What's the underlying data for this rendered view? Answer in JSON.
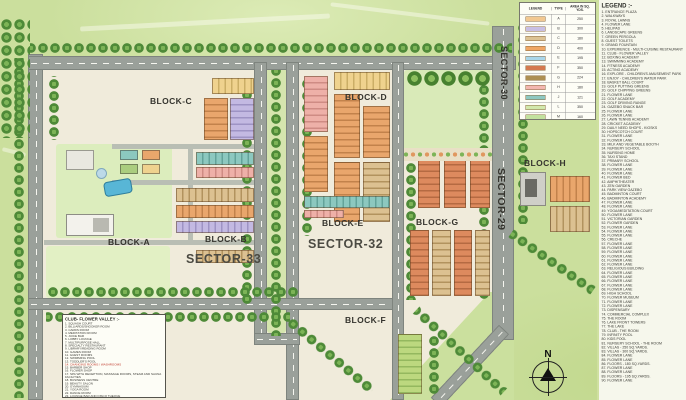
{
  "map": {
    "labels": {
      "block_a": "BLOCK-A",
      "block_b": "BLOCK-B",
      "block_c": "BLOCK-C",
      "block_d": "BLOCK-D",
      "block_e": "BLOCK-E",
      "block_f": "BLOCK-F",
      "block_g": "BLOCK-G",
      "block_h": "BLOCK-H",
      "sector_29": "SECTOR-29",
      "sector_30": "SECTOR-30",
      "sector_32": "SECTOR-32",
      "sector_33": "SECTOR-33"
    },
    "compass": {
      "north_label": "N"
    }
  },
  "legend_table": {
    "headers": [
      "LEGEND",
      "TYPE",
      "AREA IN SQ. YDS."
    ],
    "rows": [
      {
        "color": "#f2c891",
        "type": "A",
        "area": "250"
      },
      {
        "color": "#c9bfe4",
        "type": "B",
        "area": "300"
      },
      {
        "color": "#dcc394",
        "type": "C",
        "area": "180"
      },
      {
        "color": "#f0a765",
        "type": "D",
        "area": "400"
      },
      {
        "color": "#a9d6ea",
        "type": "E",
        "area": "195"
      },
      {
        "color": "#d4794f",
        "type": "F",
        "area": "350"
      },
      {
        "color": "#ad8f52",
        "type": "G",
        "area": "224"
      },
      {
        "color": "#f3b7b0",
        "type": "H",
        "area": "180"
      },
      {
        "color": "#8ec8c1",
        "type": "J",
        "area": "121"
      },
      {
        "color": "#d2e8ac",
        "type": "L",
        "area": "350"
      },
      {
        "color": "#c2e19e",
        "type": "M",
        "area": "160"
      }
    ]
  },
  "legend": {
    "title": "LEGEND :-",
    "items": [
      "ENTRANCE PLAZA",
      "WALKWAYS",
      "ROYAL LAWNS",
      "FLOWER LANE",
      "HELIPAD",
      "LANDSCAPE GREENS",
      "GREEN PERGOLA",
      "GUEST TOILETS",
      "GRAND FOUNTAIN",
      "EXPERIENCE - MULTI-CUISINE RESTAURANT",
      "CLUB - FLOWER VALLEY",
      "BOXING ACADEMY",
      "SWIMMING ACADEMY",
      "FITNESS ACADEMY",
      "ACTING ACADEMY",
      "EXPLORE - CHILDREN'S AMUSEMENT PARK",
      "ENJOY - CHILDREN'S WATER PARK",
      "BASKET BALL COURT",
      "GOLF PUTTING GREENS",
      "GOLF CHIPPING GREENS",
      "FLOWER LANE",
      "GOLF ACADEMY",
      "GOLF DRIVING RANGE",
      "GAZEBO SNACK BAR",
      "FLOWER LANE",
      "FLOWER LANE",
      "LAWN TENNIS ACADEMY",
      "CRICKET ACADEMY",
      "DAILY NEED SHOPS - KIOSKS",
      "HOPSCOTCH COURT",
      "FLOWER LANE",
      "FLOWER LANE",
      "MILK AND VEGETABLE BOOTH",
      "NURSERY SCHOOL",
      "NURSING HOME",
      "TAXI STAND",
      "PRIMARY SCHOOL",
      "FLOWER LANE",
      "FLOWER LANE",
      "FLOWER LANE",
      "FLOWER BED",
      "AMPHITHEATER",
      "ZEN GARDEN",
      "PARK VIEW GAZEBO",
      "BADMINTON COURT",
      "BADMINTON ACADEMY",
      "FLOWER LANE",
      "FLOWER LANE",
      "YOGA/MEDITATION COURT",
      "FLOWER LANE",
      "VICTORIAN GARDEN",
      "FLOWER GARDEN",
      "FLOWER LANE",
      "FLOWER LANE",
      "FLOWER LANE",
      "CRECHE",
      "FLOWER LANE",
      "FLOWER LANE",
      "FLOWER LANE",
      "FLOWER LANE",
      "FLOWER LANE",
      "FLOWER LANE",
      "RELIGIOUS BUILDING",
      "FLOWER LANE",
      "FLOWER LANE",
      "FLOWER LANE",
      "FLOWER LANE",
      "FLOWER LANE",
      "HIGH SCHOOL",
      "FLOWER MUSEUM",
      "FLOWER LANE",
      "FLOWER LANE",
      "DISPENSARY",
      "COMMERCIAL COMPLEX",
      "THE ROOM",
      "LAKE FRONT TOWERS",
      "THE LAKE",
      "CLUB - THE ROOM",
      "INFINITY POOL",
      "KIDS POOL",
      "NURSERY SCHOOL - THE ROOM",
      "VILLAS - 250 SQ.YARDS.",
      "VILLAS - 300 SQ.YARDS.",
      "FLOWER LANE",
      "FLOWER LANE",
      "FLOORS - 180 SQ.YARDS.",
      "FLOWER LANE",
      "FLOWER LANE",
      "FLOORS - 195 SQ.YARDS.",
      "FLOWER LANE"
    ]
  },
  "club": {
    "title": "CLUB- FLOWER VALLEY :-",
    "items": [
      {
        "t": "SQUASH COURT"
      },
      {
        "t": "BILLIARDS/SNOOKER ROOM"
      },
      {
        "t": "CARDS ROOM"
      },
      {
        "t": "MEDITATION ROOM"
      },
      {
        "t": "JUICE BAR"
      },
      {
        "t": "LOBBY LOUNGE"
      },
      {
        "t": "MULTIPURPOSE HALL"
      },
      {
        "t": "SPECIALTY RESTAURANT"
      },
      {
        "t": "LIBRARY/READING ROOM"
      },
      {
        "t": "GAMES ROOM"
      },
      {
        "t": "GUEST ROOMS"
      },
      {
        "t": "SWIMMING POOL"
      },
      {
        "t": "TODDLER'S POOL"
      },
      {
        "t": "CHANGING ROOMS / WASHROOMS",
        "c": "#c0392b"
      },
      {
        "t": "BARBER SHOP"
      },
      {
        "t": "FLOWER SHOP"
      },
      {
        "t": "SPA WITH RECEPTION, MASSAGE ROOMS, STEAM AND SAUNA FACILITIES"
      },
      {
        "t": "BUSINESS CENTRE"
      },
      {
        "t": "BEAUTY SALON"
      },
      {
        "t": "GYMNASIUM"
      },
      {
        "t": "YOGA ROOM"
      },
      {
        "t": "DANCE ROOM"
      },
      {
        "t": "LOUNGE BAR AND DISCO THEQUE"
      },
      {
        "t": "DANCE ACADEMY"
      }
    ]
  }
}
